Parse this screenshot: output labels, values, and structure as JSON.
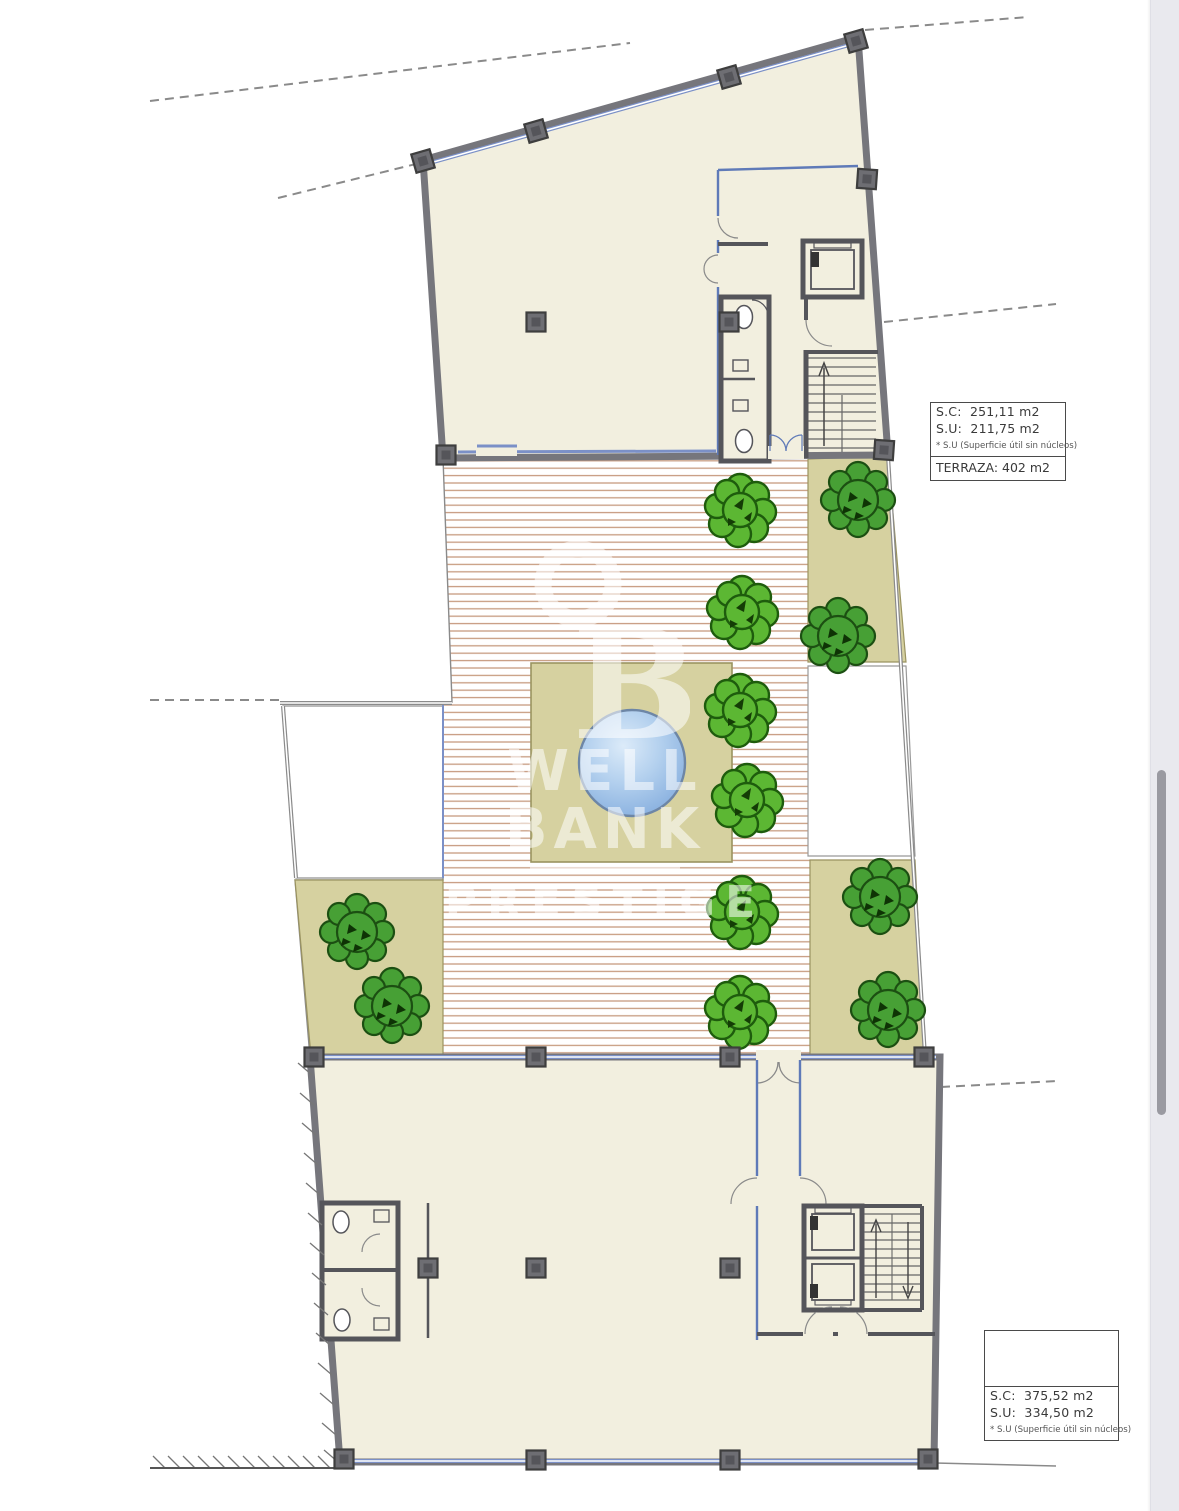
{
  "labels": {
    "box_top": {
      "sc": "S.C:  251,11 m2",
      "su": "S.U:  211,75 m2",
      "note": "* S.U (Superficie útil sin núcleos)",
      "terrace": "TERRAZA: 402 m2"
    },
    "box_bottom": {
      "sc": "S.C:  375,52 m2",
      "su": "S.U:  334,50 m2",
      "note": "* S.U (Superficie útil sin núcleos)"
    }
  },
  "watermark": {
    "logo_letter": "B",
    "line1": "WELL BANK",
    "line2": "PRESTIGE"
  },
  "colors": {
    "floor": "#f2efdf",
    "wall": "#76767c",
    "column": "#6e6e73",
    "glazing_blue": "#7b90c7",
    "partition_blue": "#5f7ab8",
    "lawn": "#d6d1a0",
    "lawn_border": "#9a9360",
    "tree": "#5cb733",
    "tree_outline": "#1e5c0d",
    "shrub": "#47a035",
    "shrub_outline": "#1c4f12",
    "pool": "#8fb4e3",
    "deck_stripe": "#c79b80",
    "boundary": "#8a8a8a",
    "scroll_track": "#e9e9ee",
    "scroll_thumb": "#9a9aa1"
  },
  "plan": {
    "trees": [
      [
        740,
        510
      ],
      [
        742,
        612
      ],
      [
        740,
        710
      ],
      [
        747,
        800
      ],
      [
        742,
        912
      ],
      [
        740,
        1012
      ]
    ],
    "shrubs": [
      [
        858,
        500
      ],
      [
        838,
        636
      ],
      [
        880,
        897
      ],
      [
        888,
        1010
      ],
      [
        357,
        932
      ],
      [
        392,
        1006
      ]
    ],
    "columns": [
      [
        423,
        161,
        -16
      ],
      [
        536,
        131,
        -16
      ],
      [
        729,
        77,
        -16
      ],
      [
        856,
        41,
        -16
      ],
      [
        867,
        179,
        4
      ],
      [
        536,
        322,
        0
      ],
      [
        729,
        322,
        0
      ],
      [
        884,
        450,
        4
      ],
      [
        446,
        455,
        0
      ],
      [
        314,
        1057,
        0
      ],
      [
        536,
        1057,
        0
      ],
      [
        730,
        1057,
        0
      ],
      [
        924,
        1057,
        0
      ],
      [
        428,
        1268,
        0
      ],
      [
        536,
        1268,
        0
      ],
      [
        730,
        1268,
        0
      ],
      [
        344,
        1459,
        0
      ],
      [
        536,
        1460,
        0
      ],
      [
        730,
        1460,
        0
      ],
      [
        928,
        1459,
        0
      ]
    ]
  }
}
